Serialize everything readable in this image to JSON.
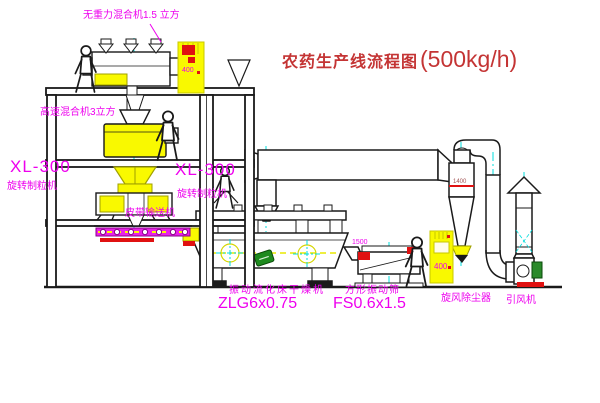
{
  "diagram": {
    "title": "农药生产线流程图",
    "title_capacity": "(500kg/h)",
    "labels": {
      "zero_gravity_mixer": "无重力混合机1.5 立方",
      "high_speed_mixer": "高速混合机3立方",
      "granulator_left_model": "XL-300",
      "granulator_left_name": "旋转制粒机",
      "granulator_right_model": "XL-300",
      "granulator_right_name": "旋转制粒机",
      "belt_conveyor": "皮带输送机",
      "dryer_name": "振动流化床干燥机",
      "dryer_model": "ZLG6x0.75",
      "screen_name": "方形振动筛",
      "screen_model": "FS0.6x1.5",
      "cyclone_name": "旋风除尘器",
      "fan_name": "引风机"
    },
    "annotations": {
      "screen_dim": "1500",
      "cyclone_dim": "1400",
      "cabinet1_code": "400",
      "cabinet2_code": "400"
    },
    "colors": {
      "label_magenta": "#ee00ee",
      "title_red": "#c43434",
      "line_black": "#1a1a1a",
      "equipment_yellow": "#f9f900",
      "centerline_cyan": "#00dcdc",
      "detail_red": "#e01111",
      "motor_green": "#2a8a2a"
    }
  }
}
